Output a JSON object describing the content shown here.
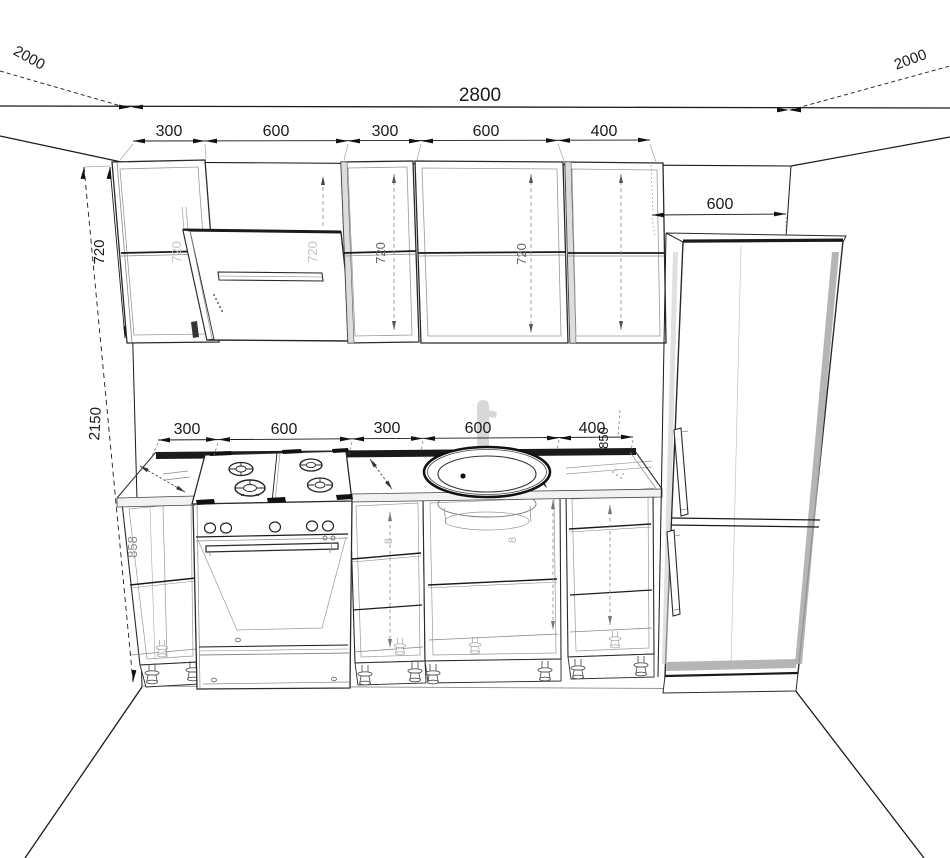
{
  "palette": {
    "ink": "#1a1a1a",
    "line_gray": "#8a8a8a",
    "faint_text": "#c4c4c4",
    "panel_shade": "#a8a8a8",
    "paper": "#ffffff"
  },
  "dimensions": {
    "room_width": "2800",
    "depth_left": "2000",
    "depth_right": "2000",
    "total_height": "2150",
    "upper_cabinet_height": "720",
    "base_cabinet_height": "858",
    "worktop_height": "850",
    "fridge_width": "600",
    "upper_row": [
      "300",
      "600",
      "300",
      "600",
      "400"
    ],
    "base_row": [
      "300",
      "600",
      "300",
      "600",
      "400"
    ],
    "watermark_digit": "8"
  }
}
